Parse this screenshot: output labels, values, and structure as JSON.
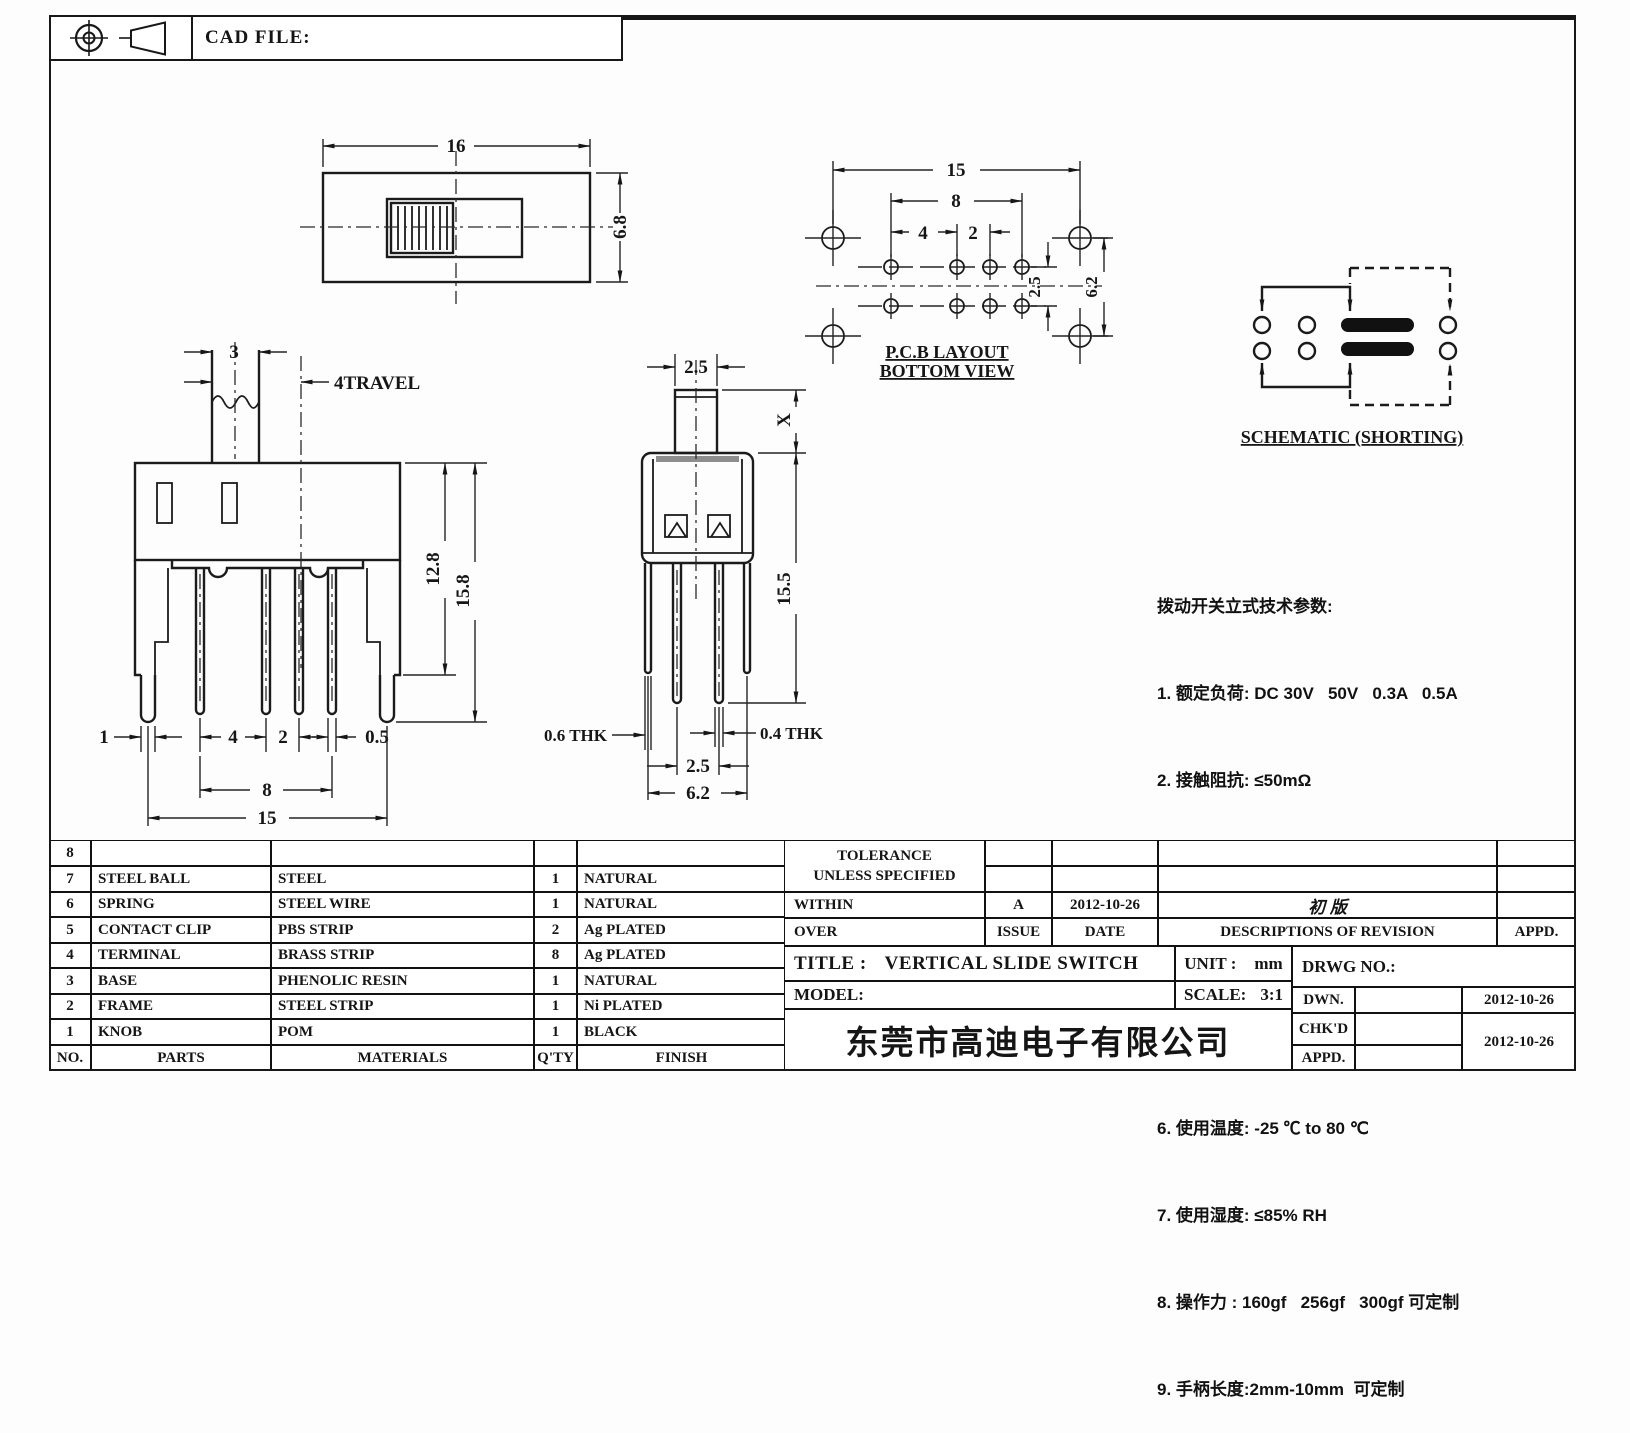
{
  "cad_header": {
    "label": "CAD FILE:"
  },
  "views": {
    "top": {
      "dim_width": "16",
      "dim_height": "6.8"
    },
    "pcb": {
      "dim_15": "15",
      "dim_8": "8",
      "dim_4": "4",
      "dim_2": "2",
      "dim_2_5": "2.5",
      "dim_6_2": "6.2",
      "caption1": "P.C.B LAYOUT",
      "caption2": "BOTTOM VIEW"
    },
    "schematic": {
      "caption": "SCHEMATIC (SHORTING)"
    },
    "front": {
      "dim_3": "3",
      "travel_label": "4TRAVEL",
      "dim_12_8": "12.8",
      "dim_15_8": "15.8",
      "dim_1": "1",
      "dim_4": "4",
      "dim_2": "2",
      "dim_0_5": "0.5",
      "dim_8": "8",
      "dim_15": "15"
    },
    "side": {
      "dim_2_5_top": "2.5",
      "dim_x": "X",
      "dim_15_5": "15.5",
      "thk_left": "0.6 THK",
      "thk_right": "0.4 THK",
      "dim_2_5_bot": "2.5",
      "dim_6_2": "6.2"
    }
  },
  "tech_params": {
    "title": "拨动开关立式技术参数:",
    "items": [
      "1. 额定负荷: DC 30V   50V   0.3A   0.5A",
      "2. 接触阻抗: ≤50mΩ",
      "3. 绝缘阻抗: ≥100mΩ  DC500V",
      "4. 耐焊温度: 250±5°  5s",
      "5. 使用寿命: 10,000 cycles",
      "6. 使用温度: -25 ℃ to 80 ℃",
      "7. 使用湿度: ≤85% RH",
      "8. 操作力 : 160gf   256gf   300gf 可定制",
      "9. 手柄长度:2mm-10mm  可定制"
    ]
  },
  "parts_table": {
    "headers": {
      "no": "NO.",
      "parts": "PARTS",
      "materials": "MATERIALS",
      "qty": "Q'TY",
      "finish": "FINISH"
    },
    "rows": [
      {
        "no": "8",
        "part": "",
        "material": "",
        "qty": "",
        "finish": ""
      },
      {
        "no": "7",
        "part": "STEEL BALL",
        "material": "STEEL",
        "qty": "1",
        "finish": "NATURAL"
      },
      {
        "no": "6",
        "part": "SPRING",
        "material": "STEEL WIRE",
        "qty": "1",
        "finish": "NATURAL"
      },
      {
        "no": "5",
        "part": "CONTACT CLIP",
        "material": "PBS STRIP",
        "qty": "2",
        "finish": "Ag PLATED"
      },
      {
        "no": "4",
        "part": "TERMINAL",
        "material": "BRASS STRIP",
        "qty": "8",
        "finish": "Ag PLATED"
      },
      {
        "no": "3",
        "part": "BASE",
        "material": "PHENOLIC RESIN",
        "qty": "1",
        "finish": "NATURAL"
      },
      {
        "no": "2",
        "part": "FRAME",
        "material": "STEEL STRIP",
        "qty": "1",
        "finish": "Ni PLATED"
      },
      {
        "no": "1",
        "part": "KNOB",
        "material": "POM",
        "qty": "1",
        "finish": "BLACK"
      }
    ]
  },
  "title_block": {
    "tolerance_line1": "TOLERANCE",
    "tolerance_line2": "UNLESS  SPECIFIED",
    "within": "WITHIN",
    "over": "OVER",
    "rev_letter": "A",
    "rev_date": "2012-10-26",
    "rev_desc": "初  版",
    "issue": "ISSUE",
    "date_label": "DATE",
    "desc_label": "DESCRIPTIONS OF REVISION",
    "appd_label": "APPD.",
    "title_label": "TITLE :",
    "title_value": "VERTICAL SLIDE SWITCH",
    "unit_label": "UNIT :",
    "unit_value": "mm",
    "model_label": "MODEL:",
    "scale_label": "SCALE:",
    "scale_value": "3:1",
    "drwg_label": "DRWG NO.:",
    "company": "东莞市高迪电子有限公司",
    "dwn_label": "DWN.",
    "chkd_label": "CHK'D",
    "appd2_label": "APPD.",
    "dwn_date": "2012-10-26",
    "chkd_date": "2012-10-26"
  }
}
